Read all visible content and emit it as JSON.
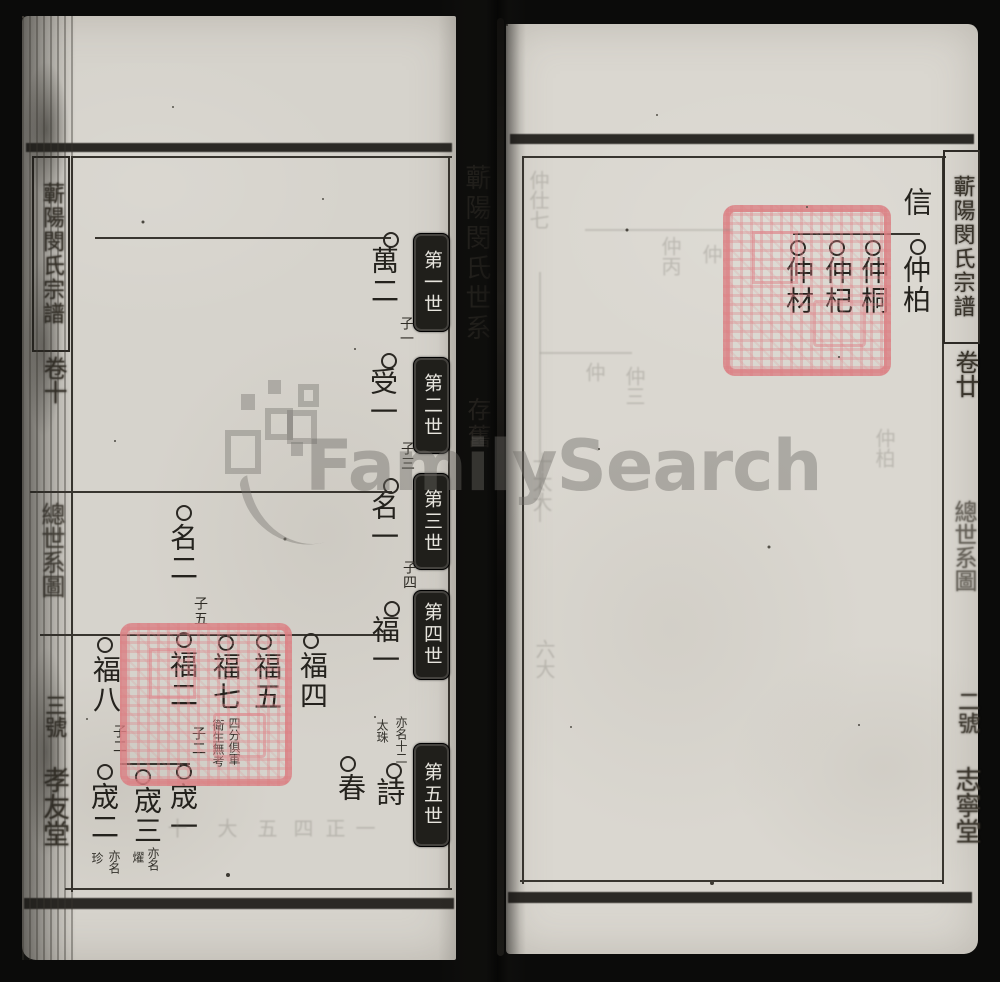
{
  "watermark_text": "FamilySearch",
  "left_spine": {
    "title": "蘄陽閔氏宗譜",
    "volume": "卷十",
    "section": "總世系圖",
    "copy_no": "三號",
    "hall": "孝友堂"
  },
  "right_spine": {
    "title": "蘄陽閔氏宗譜",
    "volume": "卷廿",
    "section": "總世系圖",
    "copy_no": "二號",
    "hall": "志寧堂"
  },
  "left_page": {
    "header_title": "蘄陽閔氏世系",
    "header_note": "存舊",
    "generations": [
      "第一世",
      "第二世",
      "第三世",
      "第四世",
      "第五世"
    ],
    "nodes": {
      "wan2": "萬二",
      "shou1": "受一",
      "ming1": "名一",
      "fu1": "福一",
      "shi": "詩",
      "ming2": "名二",
      "fu2": "福二",
      "cheng1": "宬一",
      "fu7": "福七",
      "fu5": "福五",
      "fu4": "福四",
      "chun": "春",
      "fu8": "福八",
      "cheng2": "宬二",
      "cheng3": "宬三"
    },
    "son_labels": {
      "zi1": "子一",
      "zi3": "子三",
      "zi4": "子四",
      "zi5": "子五",
      "fu2_zi2": "子二",
      "fu8_zi2": "子二"
    },
    "annotations": {
      "shi_alias_r": "亦名十二",
      "shi_alias_l": "太珠",
      "fu7_note_r": "四分俱軍",
      "fu7_note_l": "衛生無考",
      "cheng3_alias_r": "亦名",
      "cheng3_alias_l": "燿",
      "cheng2_alias_r": "亦名",
      "cheng2_alias_l": "珍"
    },
    "ghost_row": [
      "十",
      "大",
      "五",
      "四",
      "正",
      "一"
    ]
  },
  "right_page": {
    "nodes": {
      "xin": "信",
      "zhong_bai": "仲柏",
      "zhong_tong": "仲桐",
      "zhong_qi": "仲杞",
      "zhong_cai": "仲材"
    },
    "ghost_cols": [
      "仲仕七",
      "十太大",
      "六大",
      "仲",
      "仲三",
      "仲丙",
      "仲",
      "仲柏"
    ]
  },
  "colors": {
    "seal_red": "#db7d82",
    "paper": "#d8d5ce",
    "ink": "#24221d"
  }
}
